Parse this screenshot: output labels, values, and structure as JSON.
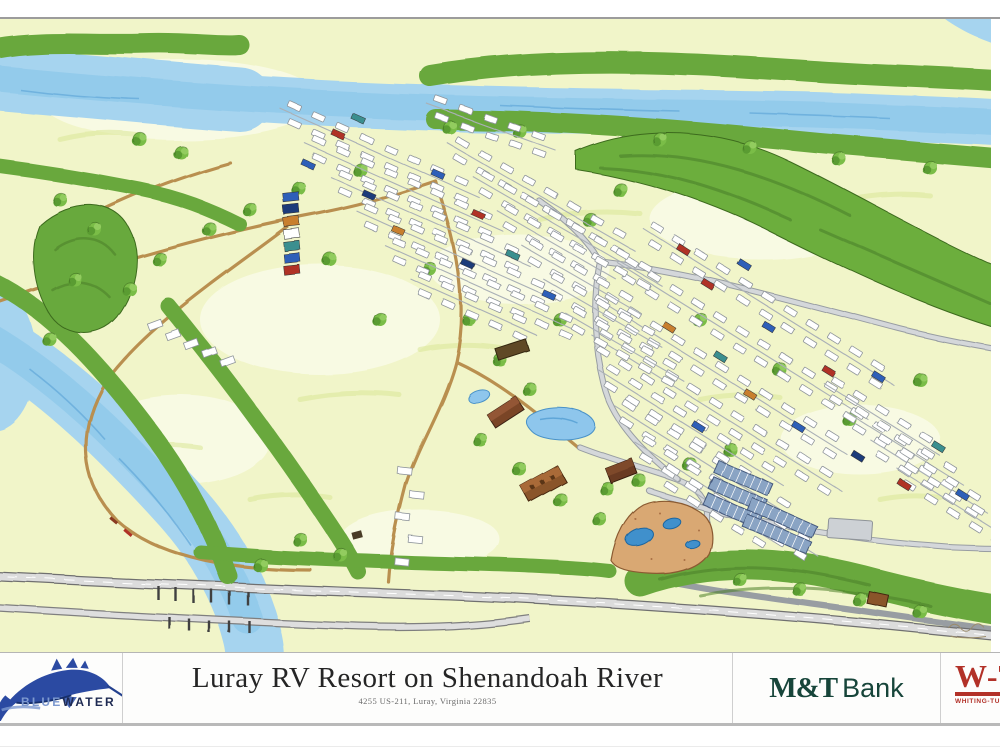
{
  "resort": {
    "title": "Luray RV Resort on Shenandoah River",
    "address": "4255 US-211, Luray, Virginia 22835"
  },
  "branding": {
    "bluewater": {
      "name_part1": "BLUE",
      "name_part2": "WATER",
      "logo_navy": "#2b4aa2",
      "text_light_blue": "#7d99cf",
      "text_dark_navy": "#1e2a52"
    },
    "mt_bank": {
      "part1": "M&T",
      "part2": "Bank",
      "green": "#17453a"
    },
    "whiting_turner": {
      "monogram": "W-T",
      "caption": "WHITING-TURNER",
      "red": "#b23128"
    }
  },
  "map_palette": {
    "meadow": "#f1f5c9",
    "river": "#a6d4ef",
    "forest": "#69a83e",
    "road_tan": "#b98f4f",
    "road_gray": "#c2c6ca",
    "pool_deck": "#d9a873",
    "pool_water": "#3f90cc",
    "solar_panel": "#8aa4c4"
  }
}
